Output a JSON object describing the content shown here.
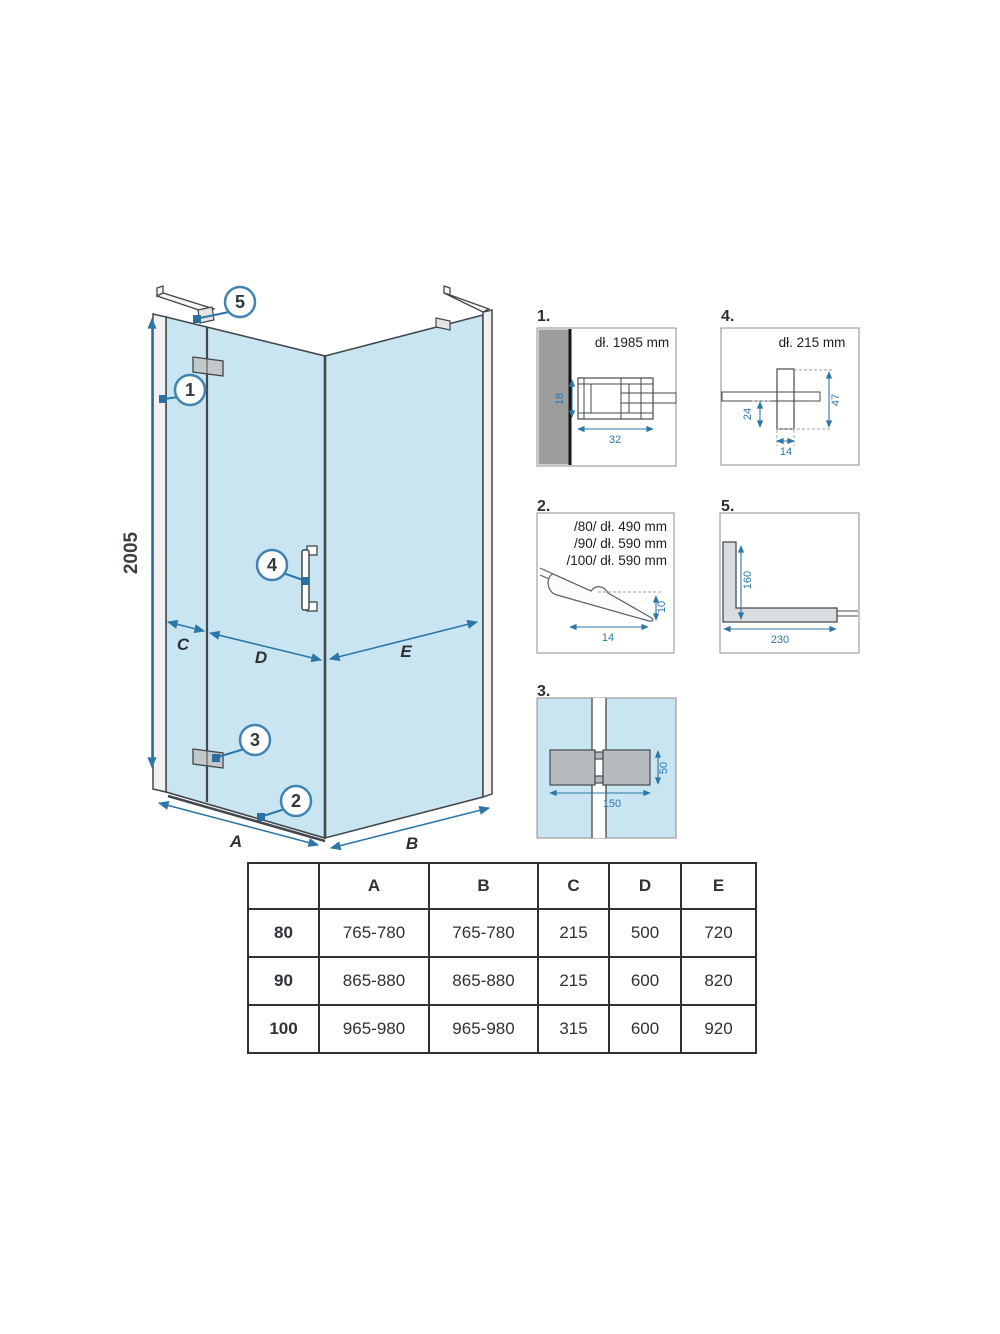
{
  "colors": {
    "glass": "#c8e5f1",
    "dim_blue": "#2d76a8",
    "outline": "#42484c",
    "wall_gray": "#9d9d9d",
    "part_gray": "#b6bbbe"
  },
  "main": {
    "height_label": "2005",
    "width_a": "A",
    "width_b": "B",
    "width_c": "C",
    "width_d": "D",
    "width_e": "E",
    "callout_1": "1",
    "callout_2": "2",
    "callout_3": "3",
    "callout_4": "4",
    "callout_5": "5"
  },
  "detail1": {
    "label": "1.",
    "note": "dł. 1985 mm",
    "dim_height": "18",
    "dim_width": "32"
  },
  "detail2": {
    "label": "2.",
    "note_80": "/80/ dł. 490 mm",
    "note_90": "/90/ dł. 590 mm",
    "note_100": "/100/ dł. 590 mm",
    "dim_height": "10",
    "dim_width": "14"
  },
  "detail3": {
    "label": "3.",
    "dim_height": "50",
    "dim_width": "150"
  },
  "detail4": {
    "label": "4.",
    "note": "dł. 215 mm",
    "dim_offset": "24",
    "dim_height": "47",
    "dim_width": "14"
  },
  "detail5": {
    "label": "5.",
    "dim_height": "160",
    "dim_width": "230"
  },
  "table": {
    "col_headers": [
      "",
      "A",
      "B",
      "C",
      "D",
      "E"
    ],
    "rows": [
      {
        "label": "80",
        "a": "765-780",
        "b": "765-780",
        "c": "215",
        "d": "500",
        "e": "720"
      },
      {
        "label": "90",
        "a": "865-880",
        "b": "865-880",
        "c": "215",
        "d": "600",
        "e": "820"
      },
      {
        "label": "100",
        "a": "965-980",
        "b": "965-980",
        "c": "315",
        "d": "600",
        "e": "920"
      }
    ]
  }
}
